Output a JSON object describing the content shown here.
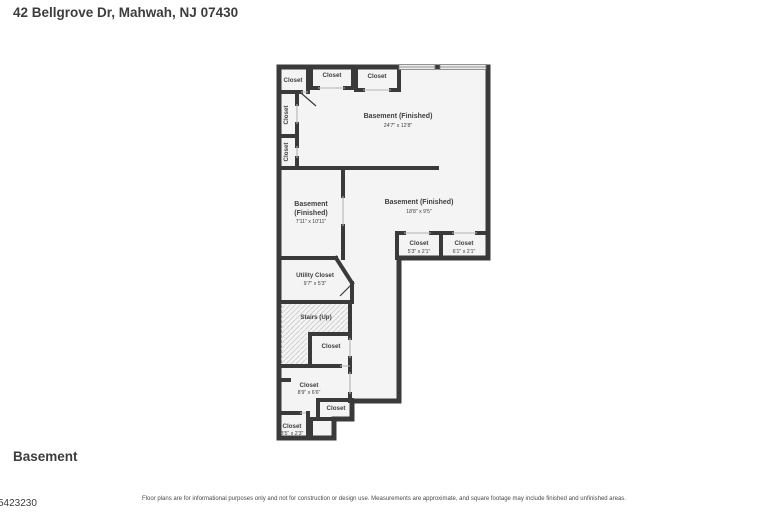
{
  "header": {
    "address": "42 Bellgrove Dr, Mahwah, NJ 07430"
  },
  "floor": {
    "label": "Basement"
  },
  "footer": {
    "disclaimer": "Floor plans are for informational purposes only and not for construction or design use. Measurements are approximate, and square footage may include finished and unfinished areas.",
    "listing_number": "5423230"
  },
  "plan": {
    "colors": {
      "wall": "#3a3a3a",
      "room_fill": "#f4f4f4",
      "label_text": "#3e3e3e",
      "hatch_line": "#cfcfcf",
      "window_fill": "#ececec"
    },
    "rooms": {
      "basement_main": {
        "name": "Basement (Finished)",
        "dims": "24'7\" x 12'8\""
      },
      "basement_left": {
        "name_line1": "Basement",
        "name_line2": "(Finished)",
        "dims": "7'11\" x 10'11\""
      },
      "basement_center": {
        "name": "Basement (Finished)",
        "dims": "18'8\" x 9'5\""
      },
      "closet_top_left": {
        "name": "Closet"
      },
      "closet_top_mid": {
        "name": "Closet"
      },
      "closet_top_right": {
        "name": "Closet"
      },
      "closet_side_upper": {
        "name": "Closet"
      },
      "closet_side_lower": {
        "name": "Closet"
      },
      "closet_right_1": {
        "name": "Closet",
        "dims": "5'3\" x 2'1\""
      },
      "closet_right_2": {
        "name": "Closet",
        "dims": "6'1\" x 2'1\""
      },
      "utility_closet": {
        "name": "Utility Closet",
        "dims": "9'7\" x 5'3\""
      },
      "stairs": {
        "name": "Stairs (Up)"
      },
      "closet_mid": {
        "name": "Closet"
      },
      "closet_lower_big": {
        "name": "Closet",
        "dims": "8'9\" x 6'6\""
      },
      "closet_lower_small": {
        "name": "Closet"
      },
      "closet_bottom_left": {
        "name": "Closet",
        "dims": "3'5\" x 2'3\""
      }
    }
  }
}
